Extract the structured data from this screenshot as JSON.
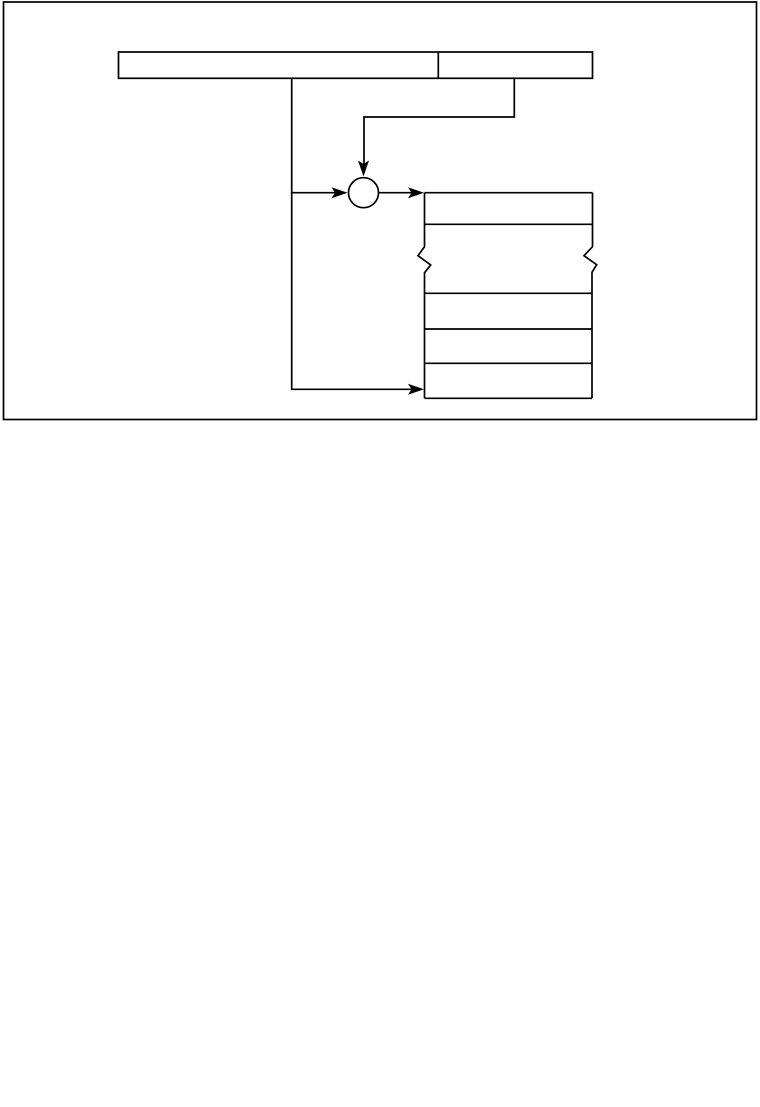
{
  "canvas": {
    "width": 760,
    "height": 1107,
    "background": "#ffffff",
    "ink": "#000000",
    "stroke_width": 1.7,
    "arrow": {
      "length": 16,
      "half_width": 5.5,
      "notch": 12.5
    }
  },
  "figure": {
    "kind": "instruction-addressing-diagram",
    "components": {
      "outer_frame": "figure-border",
      "instruction_word": {
        "fields": [
          "left-field",
          "right-address-field"
        ],
        "labels_visible": false
      },
      "adder": "circle-junction-node",
      "memory_array": {
        "visible_rows": 5,
        "break_marks": [
          "left-edge-zigzag",
          "right-edge-zigzag"
        ]
      },
      "arrows": [
        "address-field-to-adder-top",
        "left-field-to-adder-left",
        "adder-to-memory-top-row",
        "left-field-to-memory-bottom-row"
      ]
    }
  },
  "shapes": [
    {
      "type": "rect",
      "name": "figure-border",
      "x": 3.5,
      "y": 2,
      "w": 753,
      "h": 417.5
    },
    {
      "type": "rect",
      "name": "instruction-word-box",
      "x": 118.5,
      "y": 52,
      "w": 474,
      "h": 26.3
    },
    {
      "type": "line",
      "name": "instruction-field-divider",
      "x1": 438.3,
      "y1": 52,
      "x2": 438.3,
      "y2": 78.3
    },
    {
      "type": "polyline",
      "name": "left-field-connector",
      "points": "291.7,78.3 291.7,389.3 420,389.3"
    },
    {
      "type": "line",
      "name": "left-field-adder-branch",
      "x1": 291.7,
      "y1": 192.7,
      "x2": 344,
      "y2": 192.7
    },
    {
      "type": "polyline",
      "name": "address-field-connector",
      "points": "514.3,78.3 514.3,117 364,117 364,173"
    },
    {
      "type": "line",
      "name": "adder-memory-line",
      "x1": 378.5,
      "y1": 192.7,
      "x2": 420,
      "y2": 192.7
    },
    {
      "type": "circle",
      "name": "adder-circle",
      "cx": 363.5,
      "cy": 192.7,
      "r": 15
    },
    {
      "type": "arrowhead",
      "name": "adder-top-arrowhead",
      "tip": [
        363.5,
        176.5
      ],
      "dir": "down"
    },
    {
      "type": "arrowhead",
      "name": "adder-left-arrowhead",
      "tip": [
        347.5,
        192.7
      ],
      "dir": "right"
    },
    {
      "type": "arrowhead",
      "name": "memory-top-arrowhead",
      "tip": [
        424,
        192.7
      ],
      "dir": "right"
    },
    {
      "type": "arrowhead",
      "name": "memory-bottom-arrowhead",
      "tip": [
        424,
        389.3
      ],
      "dir": "right"
    },
    {
      "type": "path",
      "name": "memory-left-edge-with-break",
      "d": "M 424.5 192.7 L 424.5 246.7 L 418 255.7 L 430.7 265 L 424.5 272.7 L 424.5 398.3"
    },
    {
      "type": "path",
      "name": "memory-right-edge-with-break",
      "d": "M 592.5 192.7 L 592.5 246.7 L 584 255.7 L 596.7 264.7 L 592 272.3 L 592 398.3"
    },
    {
      "type": "line",
      "name": "memory-top-edge",
      "x1": 424.5,
      "y1": 192.7,
      "x2": 592.5,
      "y2": 192.7
    },
    {
      "type": "line",
      "name": "memory-row-divider-1",
      "x1": 424.5,
      "y1": 224.3,
      "x2": 592.5,
      "y2": 224.3
    },
    {
      "type": "line",
      "name": "memory-row-divider-2",
      "x1": 424.5,
      "y1": 293.3,
      "x2": 592.5,
      "y2": 293.3
    },
    {
      "type": "line",
      "name": "memory-row-divider-3",
      "x1": 424.5,
      "y1": 329,
      "x2": 592.5,
      "y2": 329
    },
    {
      "type": "line",
      "name": "memory-row-divider-4",
      "x1": 424.5,
      "y1": 363.3,
      "x2": 592.5,
      "y2": 363.3
    },
    {
      "type": "line",
      "name": "memory-bottom-edge",
      "x1": 424.5,
      "y1": 398.3,
      "x2": 592,
      "y2": 398.3
    }
  ]
}
